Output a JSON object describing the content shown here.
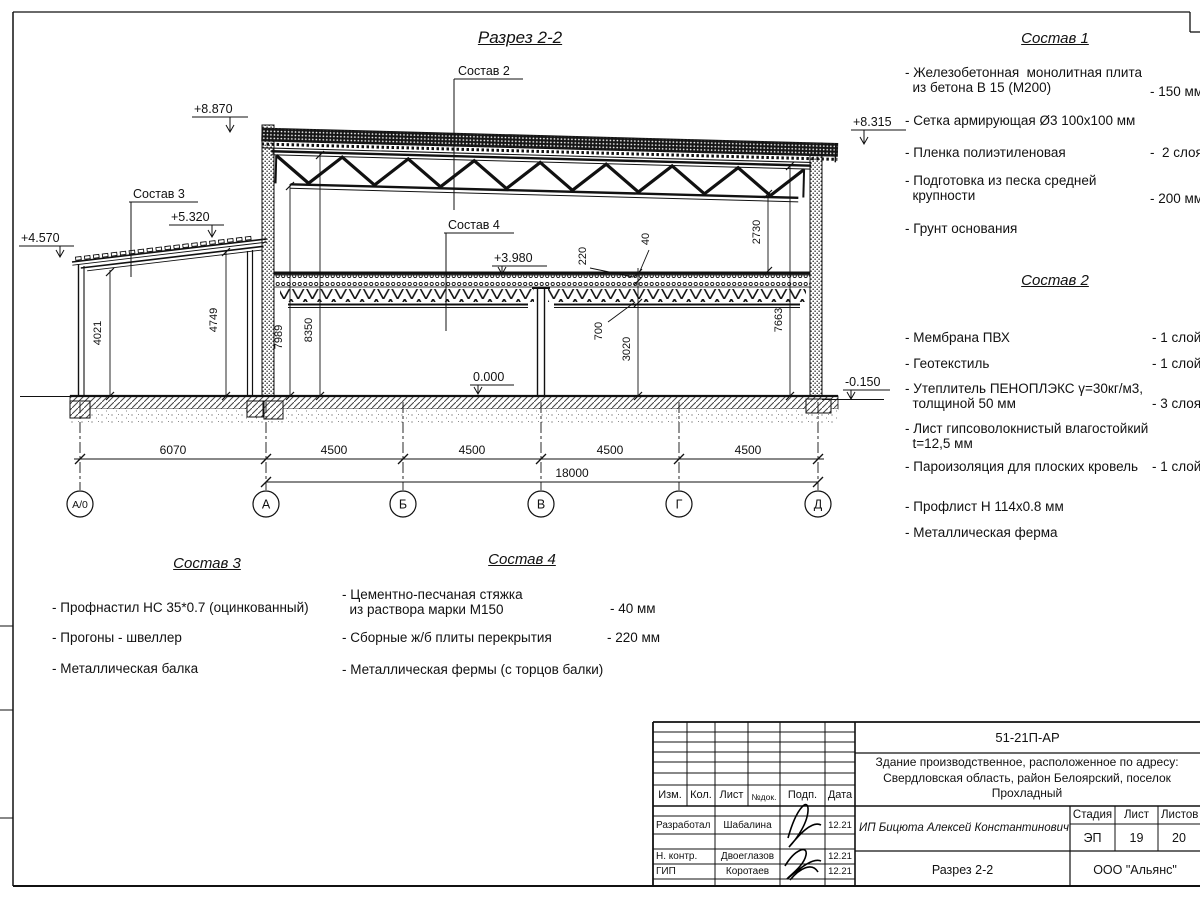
{
  "title": "Разрез 2-2",
  "compositions": {
    "c1": {
      "title": "Состав 1",
      "items": [
        {
          "text": "- Железобетонная  монолитная плита\n  из бетона В 15 (М200)",
          "value": "- 150 мм"
        },
        {
          "text": "- Сетка армирующая Ø3 100х100 мм",
          "value": ""
        },
        {
          "text": "- Пленка полиэтиленовая",
          "value": "-  2 слоя"
        },
        {
          "text": "- Подготовка из песка средней\n  крупности",
          "value": "- 200 мм"
        },
        {
          "text": "- Грунт основания",
          "value": ""
        }
      ]
    },
    "c2": {
      "title": "Состав 2",
      "items": [
        {
          "text": "- Мембрана ПВХ",
          "value": "- 1 слой"
        },
        {
          "text": "- Геотекстиль",
          "value": "- 1 слой"
        },
        {
          "text": "- Утеплитель ПЕНОПЛЭКС γ=30кг/м3,\n  толщиной 50 мм",
          "value": "- 3 слоя"
        },
        {
          "text": "- Лист гипсоволокнистый влагостойкий\n  t=12,5 мм",
          "value": ""
        },
        {
          "text": "- Пароизоляция для плоских кровель",
          "value": "- 1 слой"
        },
        {
          "text": "- Профлист Н 114х0.8 мм",
          "value": ""
        },
        {
          "text": "- Металлическая ферма",
          "value": ""
        }
      ]
    },
    "c3": {
      "title": "Состав 3",
      "items": [
        {
          "text": "- Профнастил НС 35*0.7 (оцинкованный)",
          "value": ""
        },
        {
          "text": "- Прогоны - швеллер",
          "value": ""
        },
        {
          "text": "- Металлическая балка",
          "value": ""
        }
      ]
    },
    "c4": {
      "title": "Состав 4",
      "items": [
        {
          "text": "- Цементно-песчаная стяжка\n  из раствора марки М150",
          "value": "- 40 мм"
        },
        {
          "text": "- Сборные ж/б плиты перекрытия",
          "value": "- 220 мм"
        },
        {
          "text": "- Металлическая фермы (с торцов балки)",
          "value": ""
        }
      ]
    }
  },
  "drawing": {
    "elevations": {
      "roof_left": "+8.870",
      "roof_right": "+8.315",
      "annex_right": "+5.320",
      "annex_left": "+4.570",
      "floor2": "+3.980",
      "ground": "0.000",
      "outside": "-0.150"
    },
    "leaders": {
      "s2": "Состав 2",
      "s3": "Состав 3",
      "s4": "Состав 4"
    },
    "dims": {
      "annex_l": "4021",
      "annex_r": "4749",
      "main_l1": "7989",
      "main_l2": "8350",
      "right_top": "2730",
      "right_full": "7663",
      "slab": "220",
      "screed": "40",
      "truss": "700",
      "clear": "3020",
      "bottom_row": [
        "6070",
        "4500",
        "4500",
        "4500",
        "4500"
      ],
      "total": "18000"
    },
    "axes": [
      "А/0",
      "А",
      "Б",
      "В",
      "Г",
      "Д"
    ]
  },
  "title_block": {
    "code": "51-21П-АР",
    "description": "Здание производственное, расположенное по адресу:\nСвердловская область, район Белоярский, поселок\nПрохладный",
    "client": "ИП Бицюта Алексей Константинович",
    "stage_label": "Стадия",
    "sheet_label": "Лист",
    "sheets_label": "Листов",
    "stage": "ЭП",
    "sheet": "19",
    "sheets": "20",
    "view": "Разрез 2-2",
    "org": "ООО \"Альянс\"",
    "headers": [
      "Изм.",
      "Кол.",
      "Лист",
      "№док.",
      "Подп.",
      "Дата"
    ],
    "rows": [
      {
        "role": "Разработал",
        "name": "Шабалина",
        "date": "12.21"
      },
      {
        "role": "Н. контр.",
        "name": "Двоеглазов",
        "date": "12.21"
      },
      {
        "role": "ГИП",
        "name": "Коротаев",
        "date": "12.21"
      }
    ]
  }
}
